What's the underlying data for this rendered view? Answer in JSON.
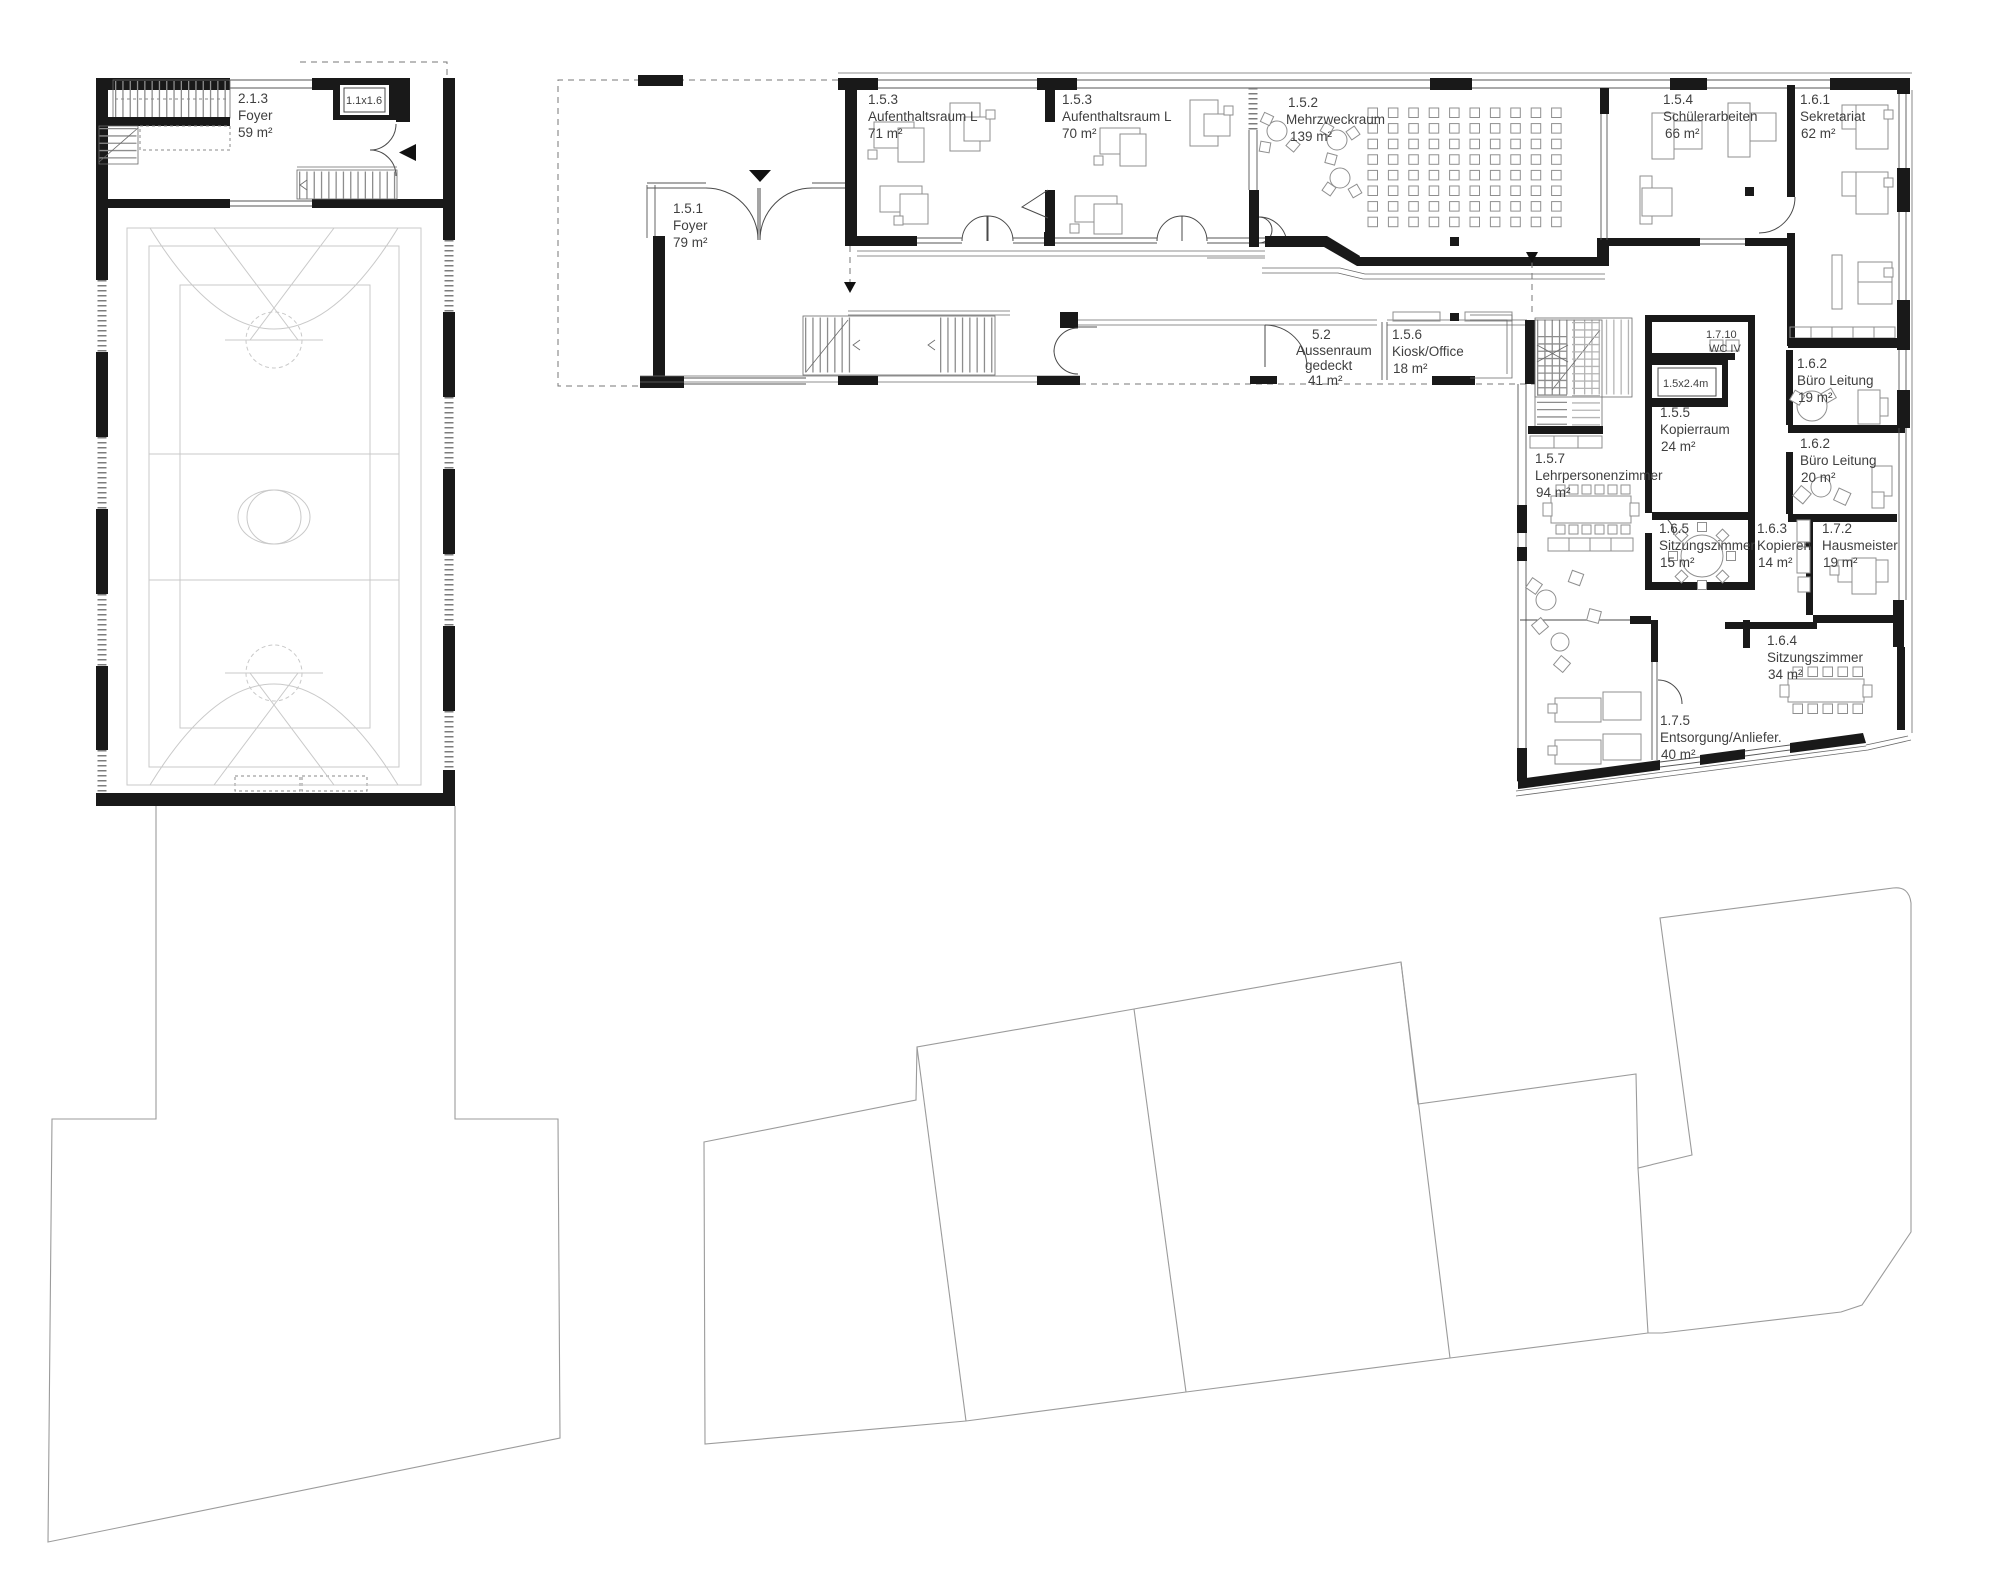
{
  "drawing": {
    "type": "architectural-floor-plan",
    "accent_color": "#191919",
    "line_color": "#9b9b9b"
  },
  "rooms": [
    {
      "id": "2.1.3",
      "name": "Foyer",
      "area": "59 m²"
    },
    {
      "id": "",
      "name": "1.1x1.6",
      "area": ""
    },
    {
      "id": "1.5.3",
      "name": "Aufenthaltsraum L",
      "area": "71 m²"
    },
    {
      "id": "1.5.3",
      "name": "Aufenthaltsraum L",
      "area": "70 m²"
    },
    {
      "id": "1.5.2",
      "name": "Mehrzweckraum",
      "area": "139 m²"
    },
    {
      "id": "1.5.4",
      "name": "Schülerarbeiten",
      "area": "66 m²"
    },
    {
      "id": "1.6.1",
      "name": "Sekretariat",
      "area": "62 m²"
    },
    {
      "id": "1.5.1",
      "name": "Foyer",
      "area": "79 m²"
    },
    {
      "id": "5.2",
      "name": "Aussenraum",
      "name2": "gedeckt",
      "area": "41 m²"
    },
    {
      "id": "1.5.6",
      "name": "Kiosk/Office",
      "area": "18 m²"
    },
    {
      "id": "1.7.10",
      "name": "WC IV",
      "area": ""
    },
    {
      "id": "",
      "name": "1.5x2.4m",
      "area": ""
    },
    {
      "id": "1.5.5",
      "name": "Kopierraum",
      "area": "24 m²"
    },
    {
      "id": "1.6.2",
      "name": "Büro Leitung",
      "area": "19 m²"
    },
    {
      "id": "1.6.2",
      "name": "Büro Leitung",
      "area": "20 m²"
    },
    {
      "id": "1.5.7",
      "name": "Lehrpersonenzimmer",
      "area": "94 m²"
    },
    {
      "id": "1.6.5",
      "name": "Sitzungszimmer",
      "area": "15 m²"
    },
    {
      "id": "1.6.3",
      "name": "Kopieren",
      "area": "14 m²"
    },
    {
      "id": "1.7.2",
      "name": "Hausmeister",
      "area": "19 m²"
    },
    {
      "id": "1.6.4",
      "name": "Sitzungszimmer",
      "area": "34 m²"
    },
    {
      "id": "1.7.5",
      "name": "Entsorgung/Anliefer.",
      "area": "40 m²"
    }
  ]
}
